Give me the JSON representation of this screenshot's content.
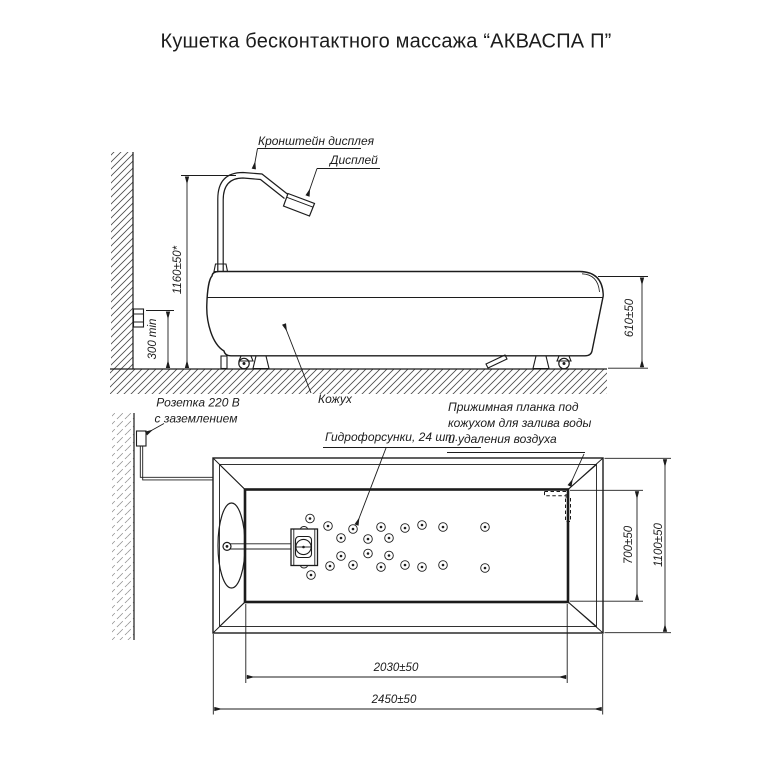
{
  "title": "Кушетка бесконтактного массажа “АКВАСПА П”",
  "side_view": {
    "labels": {
      "bracket": "Кронштейн дисплея",
      "display": "Дисплей",
      "cover": "Кожух",
      "socket": [
        "Розетка 220 В",
        "с заземлением"
      ]
    },
    "dims": {
      "bracket_height": "1160±50*",
      "socket_min_height": "300 min",
      "couch_height": "610±50"
    }
  },
  "top_view": {
    "labels": {
      "nozzles": "Гидрофорсунки, 24 шт.",
      "clamp": [
        "Прижимная планка под",
        "кожухом для залива воды",
        "и удаления воздуха"
      ]
    },
    "dims": {
      "inner_width": "700±50",
      "outer_width": "1100±50",
      "inner_length": "2030±50",
      "outer_length": "2450±50"
    },
    "nozzle_count": "24"
  },
  "colors": {
    "line": "#1c1c1c",
    "background": "#ffffff"
  }
}
